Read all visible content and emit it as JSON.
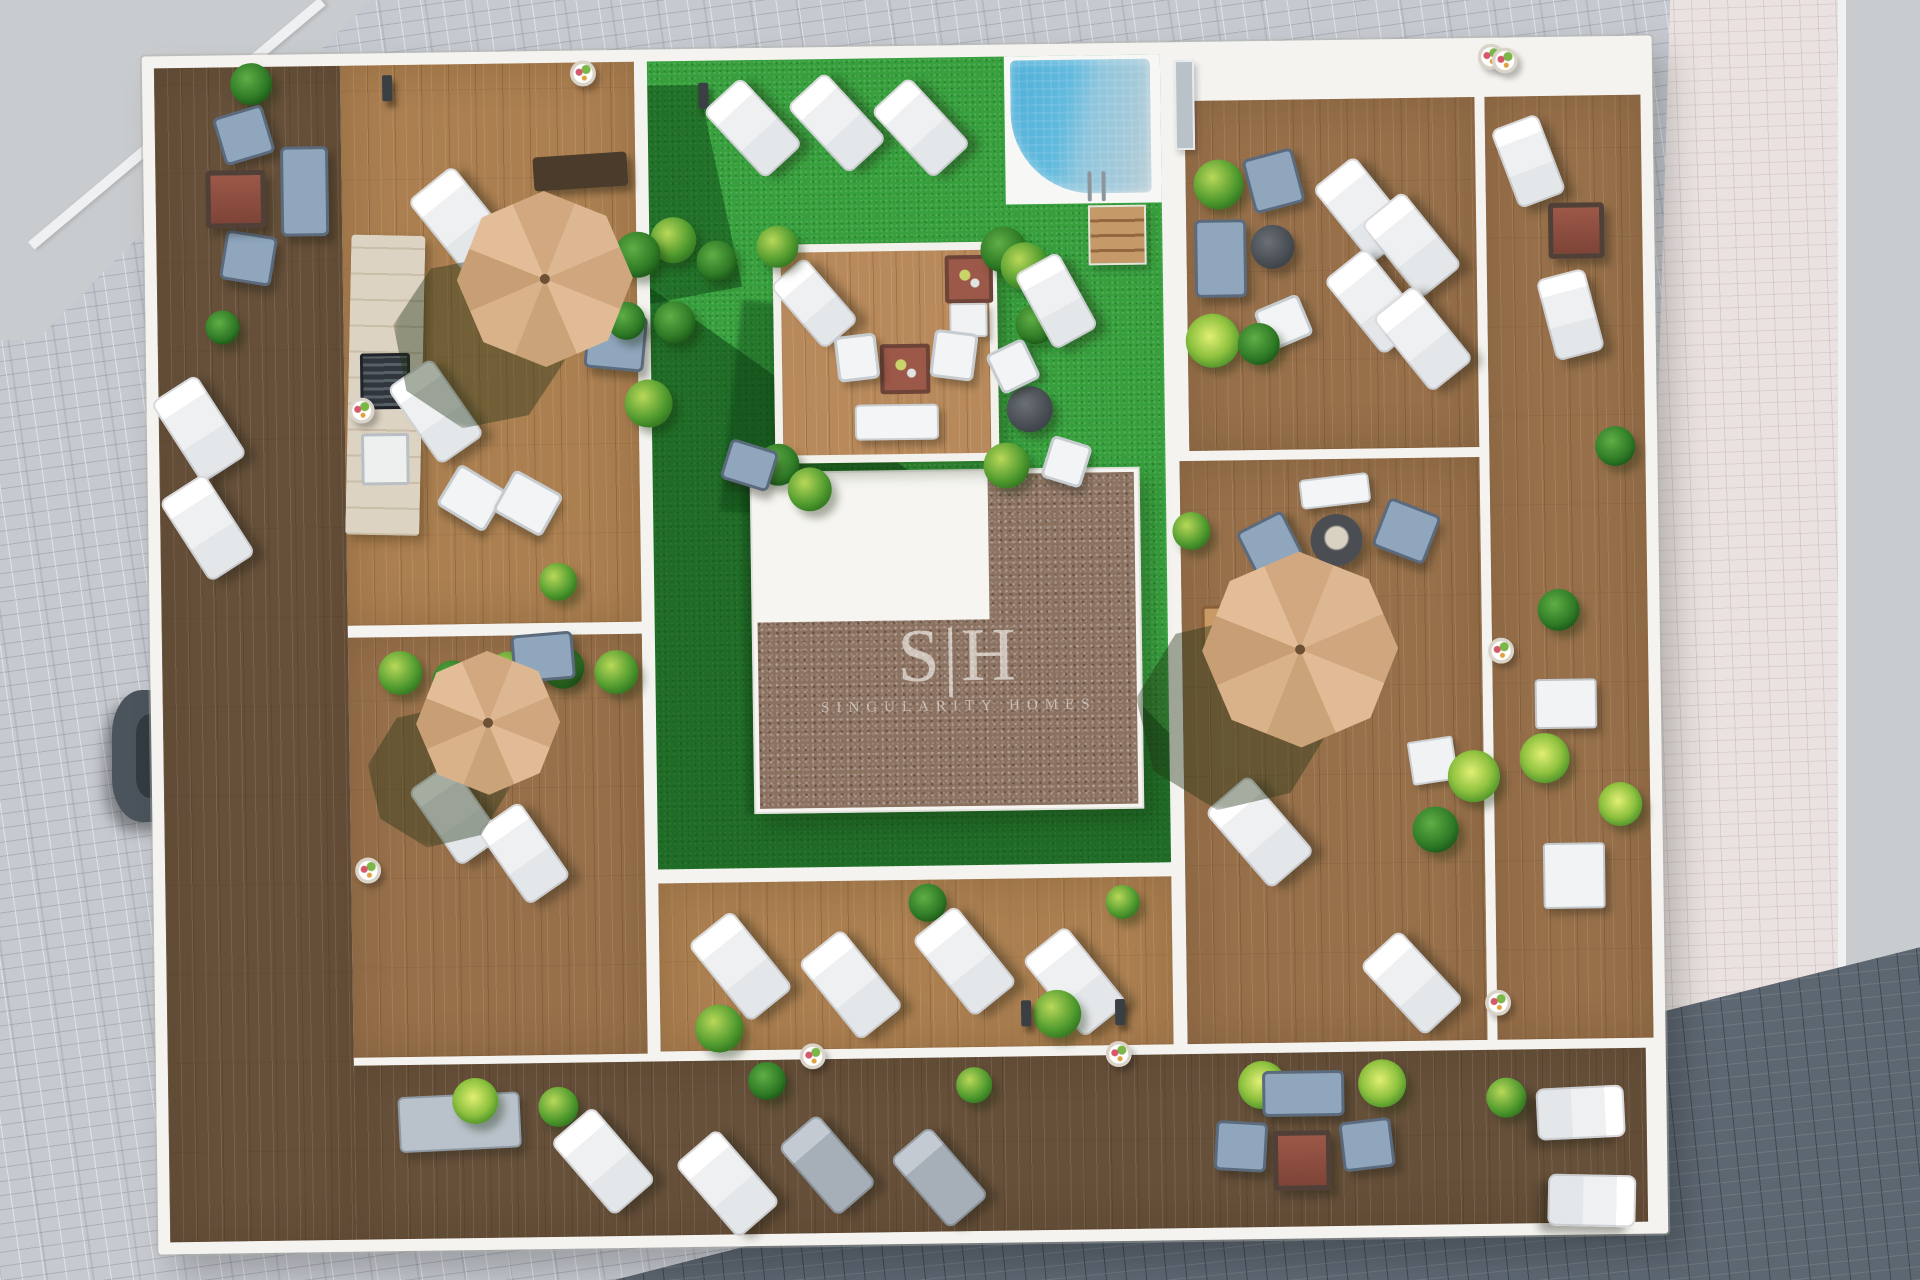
{
  "watermark": {
    "logo": "S|H",
    "name": "SINGULARITY HOMES"
  },
  "colors": {
    "pavement_gray": "#c6cad0",
    "pavement_pink": "#e9e2e0",
    "road_gray": "#c9cccf",
    "cobble_dark": "#5d6772",
    "wall_white": "#f4f3ef",
    "deck_light": "#ab7f50",
    "deck_mid": "#97704a",
    "deck_dark": "#66503a",
    "turf_green": "#37a03d",
    "pool_blue": "#4fb0d9",
    "gravel_brown": "#8b7160",
    "umbrella_tan": "#d9b08c",
    "sofa_blue": "#8fa6bd",
    "fire_table": "#9c5848",
    "plant_green": "#4f9a2e",
    "plant_dark": "#164d14",
    "lounger_white": "#f2f4f6"
  }
}
